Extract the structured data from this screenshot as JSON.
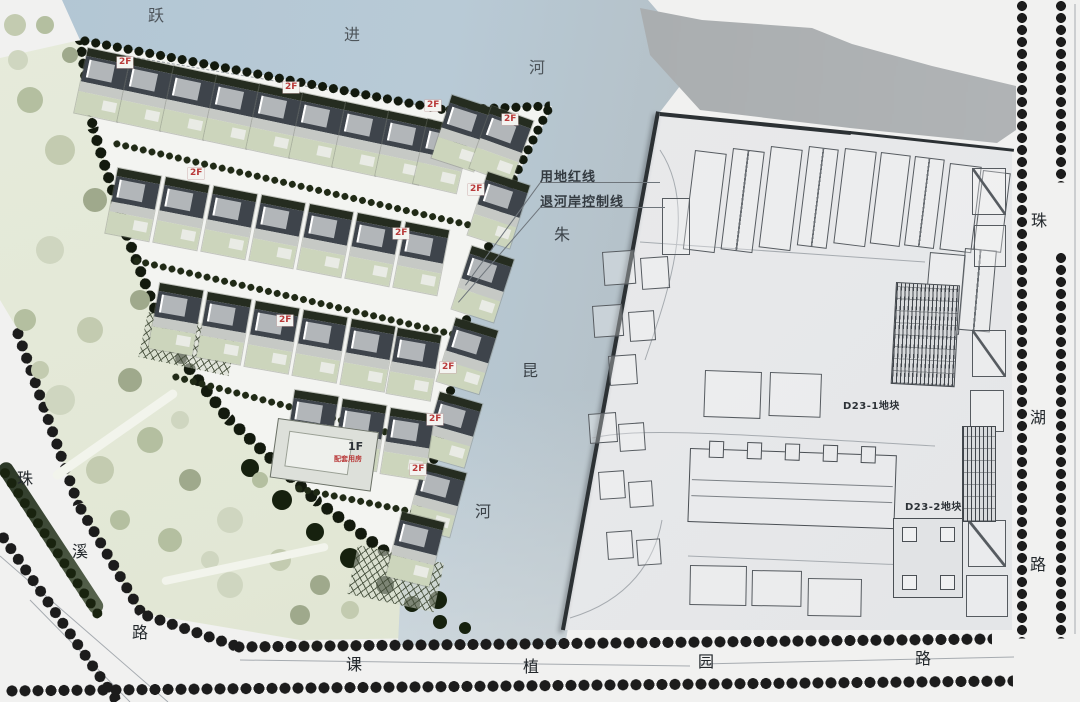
{
  "labels": {
    "river_top": [
      "跃",
      "进",
      "河"
    ],
    "river_side": [
      "朱",
      "昆",
      "河"
    ],
    "road_west": [
      "珠",
      "溪",
      "路"
    ],
    "road_south": [
      "课",
      "植",
      "园",
      "路"
    ],
    "road_east": [
      "珠",
      "湖",
      "路"
    ],
    "red_line": "用地红线",
    "setback_line": "退河岸控制线",
    "parcel_1": "D23-1地块",
    "parcel_2": "D23-2地块",
    "floor_2": "2F",
    "floor_1": "1F",
    "support_room": "配套用房"
  },
  "colors": {
    "water_blue": "#b5c8d5",
    "water_gray": "#a9adb0",
    "park_green": "#e3e8d7",
    "site_ground": "#f3f4f1",
    "d23_ground": "#e8e9ea",
    "tree_dark": "#131a0e",
    "tree_street": "#1c1c1c",
    "badge_red": "#b93a3a",
    "roof_dark": "#3e444b"
  }
}
